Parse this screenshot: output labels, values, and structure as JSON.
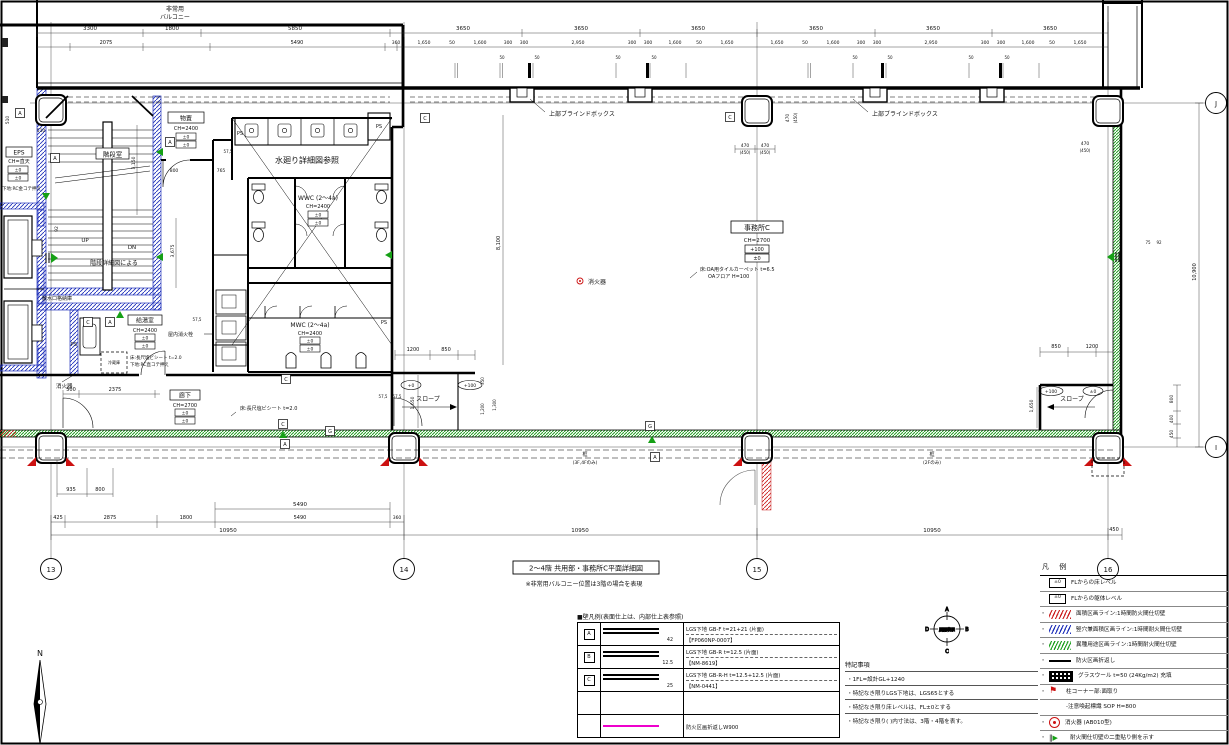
{
  "title": {
    "box": "2〜4階 共用部・事務所C平面詳細図",
    "note": "※非常用バルコニー位置は3階の場合を表現"
  },
  "grid": {
    "g13": "13",
    "g14": "14",
    "g15": "15",
    "g16": "16",
    "gJ": "J",
    "gI": "I"
  },
  "rooms": {
    "balcony1": "非常用",
    "balcony2": "バルコニー",
    "blind_box": "上部ブラインドボックス",
    "stair": "階段室",
    "stair_note": "階段詳細図による",
    "up": "UP",
    "dn": "DN",
    "sansui": "散水口格納庫",
    "storage": "物置",
    "storage_ch": "CH=2400",
    "eps": "EPS",
    "eps_ch": "CH=直天",
    "eps_note": "下地:RC金コテ押え",
    "mizumawari": "水廻り詳細図参照",
    "wwc": "WWC (2〜4a)",
    "wwc_ch": "CH=2400",
    "mwc": "MWC (2〜4a)",
    "mwc_ch": "CH=2400",
    "kyutou": "給湯室",
    "kyutou_ch": "CH=2400",
    "kyutou_note1": "床:長尺塩ビシート t=2.0",
    "kyutou_note2": "下地:RC直コテ押え",
    "reizouko": "冷蔵庫",
    "rouka": "廊下",
    "rouka_ch": "CH=2700",
    "rouka_note": "床:長尺塩ビシート t=2.0",
    "office": "事務所C",
    "office_ch": "CH=2700",
    "office_note1": "床:OA用タイルカーペット t=6.5",
    "office_note2": "OAフロア H=100",
    "slope": "スロープ",
    "shoukaki": "消火器",
    "okunai": "屋内消火栓",
    "kamachi": "框",
    "kamachi_34": "(3F,4Fのみ)",
    "kamachi_2": "(2Fのみ)",
    "ps": "PS",
    "lv0": "±0",
    "lv100": "+100",
    "lv_p0": "+0"
  },
  "tags": {
    "a": "A",
    "b": "B",
    "c": "C",
    "g": "G"
  },
  "dims": {
    "top1": [
      "3300",
      "1800",
      "5850"
    ],
    "module": "3650",
    "top2": [
      "2075",
      "5490",
      "360"
    ],
    "sub": [
      "1,650",
      "50",
      "1,600",
      "300",
      "300",
      "2,950",
      "300",
      "300",
      "1,600",
      "50",
      "1,650"
    ],
    "sub50": "50",
    "col470": "470",
    "col450": "(450)",
    "b935": "935",
    "b800": "800",
    "b5490": "5490",
    "bottom2": [
      "425",
      "2875",
      "1800",
      "5490",
      "360"
    ],
    "total": "10950",
    "b450": "450",
    "d500": "500",
    "d2375": "2375",
    "d575": "57,5",
    "d765": "765",
    "d800": "800",
    "d510": "510",
    "d92": "92",
    "d75": "75",
    "v3150": "3,150",
    "v3675": "3,675",
    "v8100": "8,100",
    "v10900": "10,900",
    "s1200": "1200",
    "s850": "850",
    "s1650": "1,650",
    "s350": "350",
    "s1200b": "1,200",
    "s1300": "1,300",
    "e800": "800",
    "e400": "400",
    "e450": "450"
  },
  "legend": {
    "header": "凡 例",
    "bullet": "・",
    "pm0": "±0",
    "lv_floor": "FLからの床レベル",
    "lv_body": "FLからの躯体レベル",
    "area_line": "面積区画ライン:1時間防火間仕切壁",
    "tateana": "竪穴兼面積区画ライン:1時間耐火間仕切壁",
    "ishu": "異種用途区画ライン:1時間耐火間仕切壁",
    "orikaeshi": "防火区画折返し",
    "glasswool": "グラスウール t=50 (24Kg/m2) 充填",
    "corner": "柱コーナー部:面取り",
    "sign": "-注意喚起標識 SOP H=800",
    "ext": "消火器 (AB010型)",
    "double": "耐火間仕切壁の二重貼り側を示す"
  },
  "wall_legend": {
    "header": "■壁凡例(表面仕上は、内部仕上表参照)",
    "rows": [
      {
        "tag": "A",
        "desc1": "LGS下地 GB-F t=21+21 (片面)",
        "desc2": "【FP060NP-0007】",
        "th": "42"
      },
      {
        "tag": "B",
        "desc1": "LGS下地 GB-R t=12.5 (片面)",
        "desc2": "【NM-8619】",
        "th": "12.5"
      },
      {
        "tag": "C",
        "desc1": "LGS下地 GB-R-H t=12.5+12.5 (片面)",
        "desc2": "【NM-0441】",
        "th": "25"
      },
      {
        "tag": "",
        "desc1": "",
        "desc2": "",
        "th": ""
      },
      {
        "tag": "",
        "desc1": "防火区画折返しW900",
        "desc2": "",
        "th": ""
      }
    ]
  },
  "notes": {
    "header": "特記事項",
    "items": [
      "・1FL=設計GL+1240",
      "・特記なき限りLGS下地は、LGS65とする",
      "・特記なき限り床レベルは、FL±0とする",
      "・特記なき限り( )内寸法は、3階・4階を表す。"
    ]
  },
  "kaihyo": {
    "label": "展開表示",
    "a": "A",
    "b": "B",
    "c": "C",
    "d": "D"
  },
  "compass": {
    "n": "N"
  }
}
